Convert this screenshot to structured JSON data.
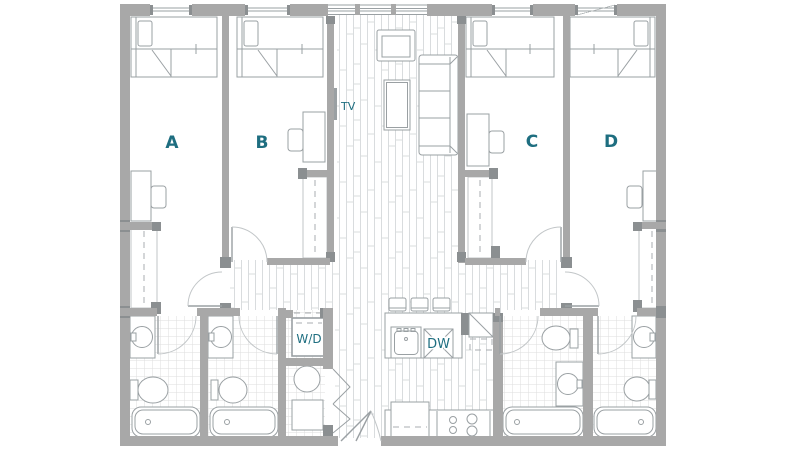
{
  "colors": {
    "accent": "#1e6e80",
    "wall": "#a8a8a8",
    "wall-dark": "#8b8f91",
    "line": "#9aa0a3",
    "floor-line": "#d9dcde"
  },
  "labels": {
    "bedrooms": [
      "A",
      "B",
      "C",
      "D"
    ],
    "tv": "TV",
    "washer_dryer": "W/D",
    "dishwasher": "DW"
  }
}
